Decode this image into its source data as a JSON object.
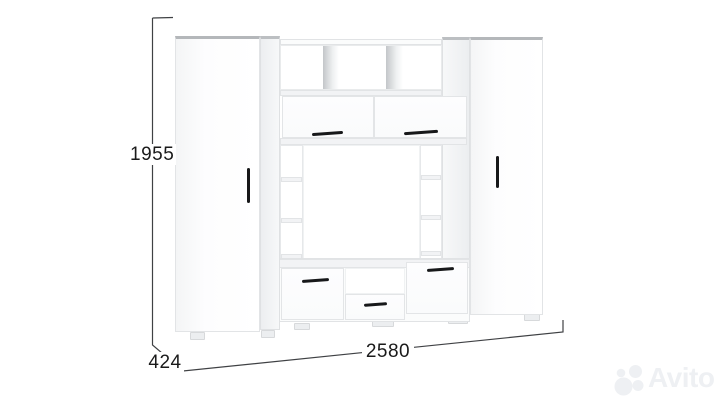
{
  "page": {
    "background": "#ffffff"
  },
  "dimensions": {
    "height_mm": "1955",
    "width_mm": "2580",
    "depth_mm": "424"
  },
  "watermark": {
    "text": "Avito",
    "icon": "avito-four-circles-logo",
    "color": "#eef0f3"
  },
  "colors": {
    "furniture_body": "#ffffff",
    "side_shade": "#eceef0",
    "top_edge": "#b4b7ba",
    "panel_edge": "#e2e4e6",
    "handle": "#17181a",
    "dimension_line": "#3f4144",
    "label_text": "#1a1a1a"
  }
}
